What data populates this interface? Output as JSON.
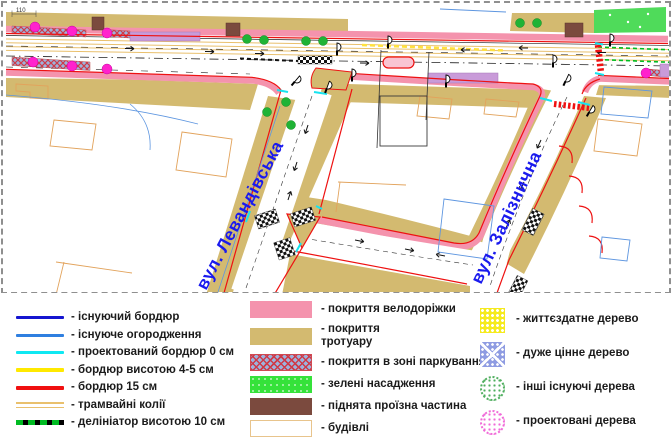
{
  "palette": {
    "tan": "#d3ba70",
    "pink": "#f493ad",
    "road-red": "#ee1111",
    "cyan": "#17e3ef",
    "tram": "#e9c06d",
    "yellow": "#ffe23f",
    "magenta": "#ff22cd",
    "tree-green": "#1fb335",
    "area-green": "#4fdb5a",
    "delin-green": "#00bb22",
    "plum": "#c99bd9",
    "brown": "#7b4a3e",
    "label-blue": "#1a1aee",
    "bldg-orange": "#e2a35c",
    "bldg-blue": "#5e96e0"
  },
  "map": {
    "street_labels": {
      "levandivska": "вул. Левандівська",
      "zaliznychna": "вул. Залізнична"
    },
    "dimension_label": "110"
  },
  "legend": {
    "lines": [
      {
        "label": "- існуючий бордюр",
        "color": "#1515d0"
      },
      {
        "label": "- існуюче огородження",
        "color": "#2f7fe0"
      },
      {
        "label": "- проектований бордюр 0 см",
        "color": "#0fe8f2"
      },
      {
        "label": "- бордюр висотою 4-5 см",
        "color": "#ffe900"
      },
      {
        "label": "- бордюр 15 см",
        "color": "#f01010"
      },
      {
        "label": "- трамвайні колії",
        "color": "#e9c06d"
      },
      {
        "label": "- делініатор висотою 10 см",
        "color": "#00bb22",
        "base_color": "#000000"
      }
    ],
    "areas": [
      {
        "label": "- покриття велодоріжки",
        "color": "#f493ad"
      },
      {
        "label": "- покриття тротуару",
        "color": "#d3ba70"
      },
      {
        "label": "- покриття в зоні паркування",
        "color": "#9db3dd",
        "hatch_color": "#cf3a48"
      },
      {
        "label": "- зелені насадження",
        "color": "#35e23a"
      },
      {
        "label": "- піднята проїзна частина",
        "color": "#7b4a3e"
      },
      {
        "label": "- будівлі",
        "color": "#ffffff",
        "border_color": "#e8c48c"
      }
    ],
    "trees": [
      {
        "label": "- життєздатне дерево",
        "color": "#f5ea1e"
      },
      {
        "label": "- дуже цінне дерево",
        "color": "#8f9ce2"
      },
      {
        "label": "- інші існуючі дерева",
        "color": "#4fae5e"
      },
      {
        "label": "- проектовані дерева",
        "color": "#f06ad8"
      }
    ]
  }
}
